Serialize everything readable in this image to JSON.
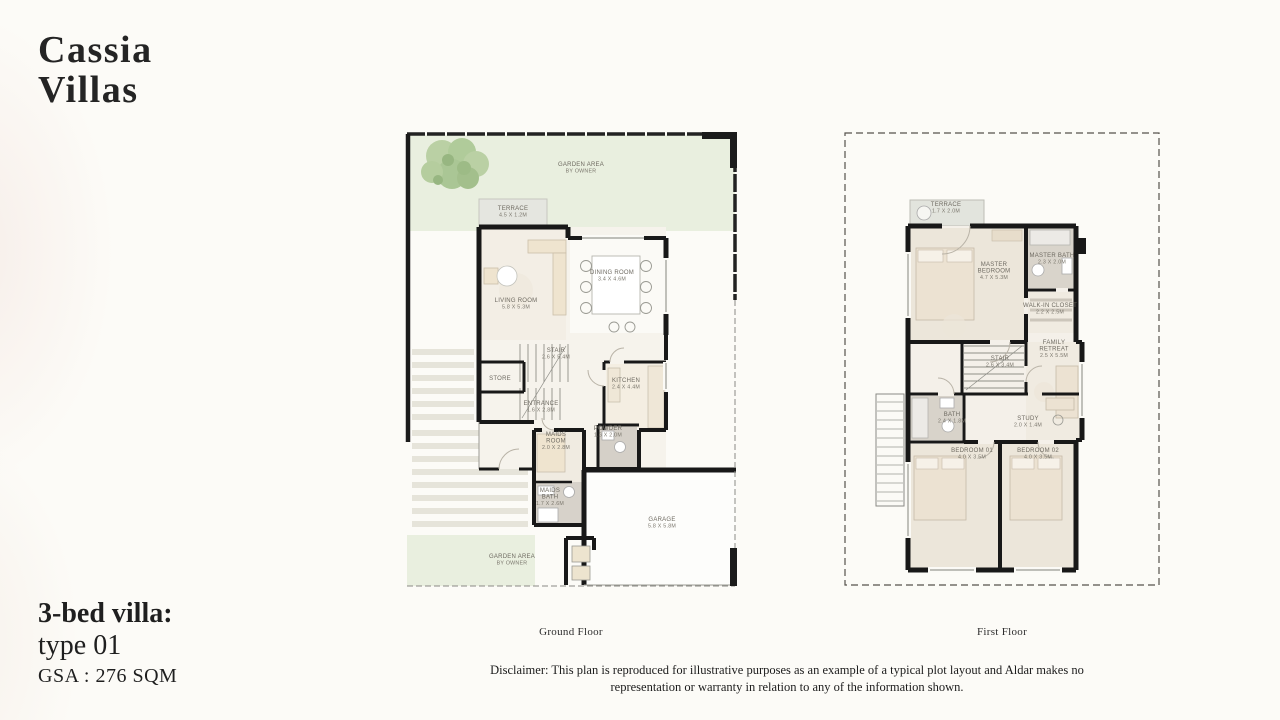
{
  "header": {
    "title_line1": "Cassia",
    "title_line2": "Villas"
  },
  "info": {
    "line1": "3-bed villa:",
    "line2": "type 01",
    "gsa": "GSA : 276 SQM"
  },
  "footer": {
    "disclaimer": "Disclaimer: This plan is reproduced for illustrative purposes as an example of a typical plot layout and Aldar makes no representation or warranty in relation to any of the information shown."
  },
  "colors": {
    "background": "#fcfbf7",
    "wall": "#181818",
    "garden": "#e9efdf",
    "floor": "#f5f1ea",
    "furniture": "#efe4cf",
    "terrace": "#e5e6e0",
    "bath": "#d8d3ca",
    "tree": "#b5cd9e",
    "label": "#6e6a61"
  },
  "ground_floor": {
    "caption": "Ground Floor",
    "rooms": {
      "garden_top": [
        "GARDEN AREA",
        "BY OWNER"
      ],
      "terrace": [
        "TERRACE",
        "4.5 X 1.2M"
      ],
      "living": [
        "LIVING ROOM",
        "5.8 X 5.3M"
      ],
      "dining": [
        "DINING ROOM",
        "3.4 X 4.6M"
      ],
      "stair": [
        "STAIR",
        "2.6 X 5.4M"
      ],
      "store": [
        "STORE"
      ],
      "entrance": [
        "ENTRANCE",
        "1.6 X 2.8M"
      ],
      "kitchen": [
        "KITCHEN",
        "2.4 X 4.4M"
      ],
      "powder": [
        "POWDER",
        "1.6 X 2.0M"
      ],
      "maids_room": [
        "MAIDS",
        "ROOM",
        "2.0 X 2.8M"
      ],
      "maids_bath": [
        "MAIDS",
        "BATH",
        "1.7 X 2.6M"
      ],
      "garage": [
        "GARAGE",
        "5.8 X 5.8M"
      ],
      "garden_bottom": [
        "GARDEN AREA",
        "BY OWNER"
      ]
    }
  },
  "first_floor": {
    "caption": "First Floor",
    "rooms": {
      "terrace": [
        "TERRACE",
        "1.7 X 2.0M"
      ],
      "master_bedroom": [
        "MASTER",
        "BEDROOM",
        "4.7 X 5.3M"
      ],
      "master_bath": [
        "MASTER BATH",
        "2.3 X 2.0M"
      ],
      "walk_in_closet": [
        "WALK-IN CLOSET",
        "2.2 X 2.5M"
      ],
      "family_retreat": [
        "FAMILY",
        "RETREAT",
        "2.5 X 5.5M"
      ],
      "stair": [
        "STAIR",
        "2.6 X 3.4M"
      ],
      "bath": [
        "BATH",
        "2.4 X 1.8M"
      ],
      "study": [
        "STUDY",
        "2.0 X 1.4M"
      ],
      "bedroom_01": [
        "BEDROOM 01",
        "4.0 X 3.5M"
      ],
      "bedroom_02": [
        "BEDROOM 02",
        "4.0 X 3.5M"
      ]
    }
  }
}
